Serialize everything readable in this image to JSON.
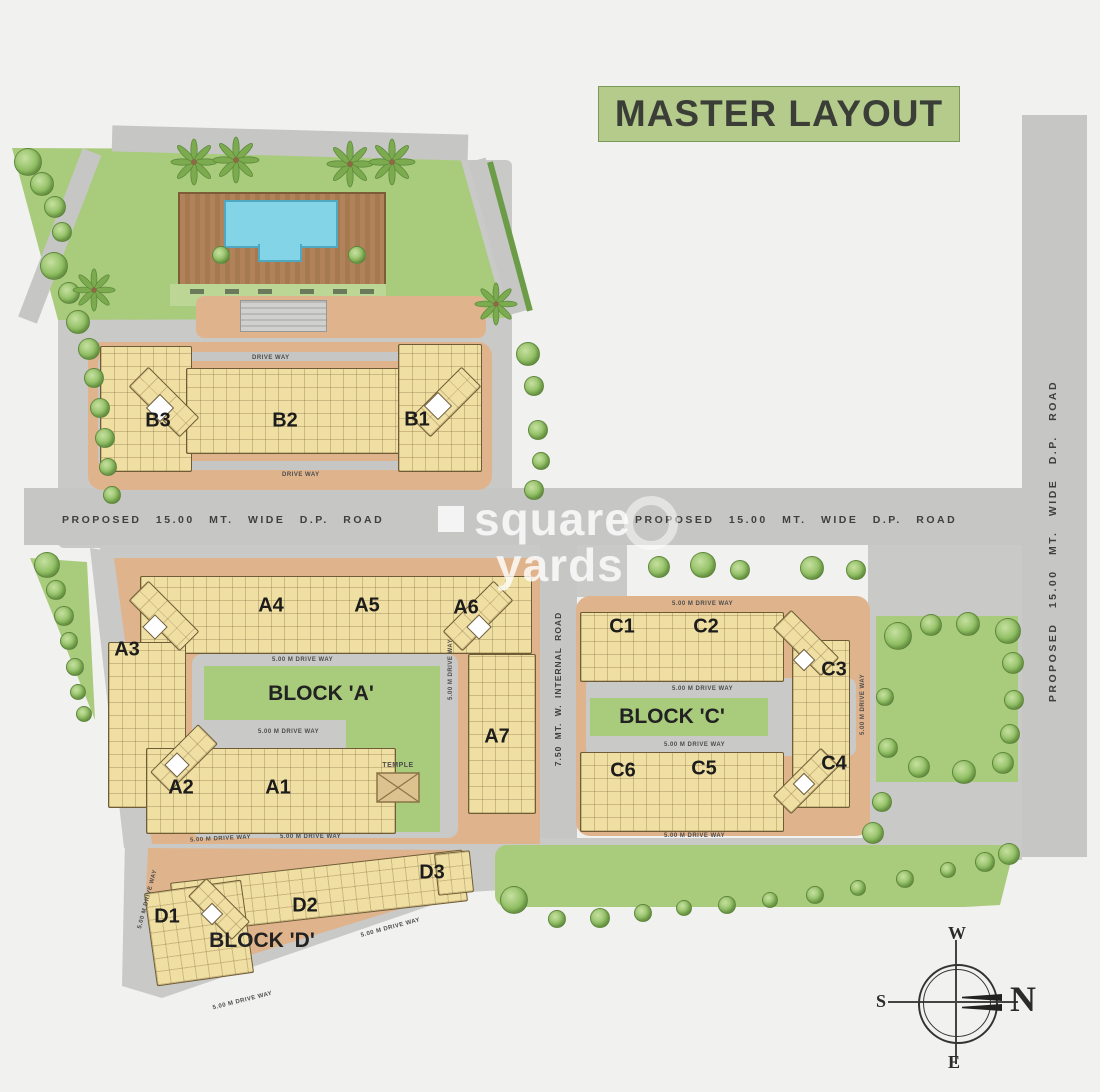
{
  "page": {
    "title": "MASTER LAYOUT"
  },
  "watermark": {
    "word1": "square",
    "word2": "yards"
  },
  "roads": {
    "dp_road": "PROPOSED 15.00 MT. WIDE D.P. ROAD",
    "internal_road": "7.50 MT. W. INTERNAL ROAD",
    "drive_way": "DRIVE WAY",
    "drive_way_5m": "5.00 M DRIVE WAY"
  },
  "blocks": {
    "a": {
      "name": "BLOCK 'A'",
      "buildings": [
        "A1",
        "A2",
        "A3",
        "A4",
        "A5",
        "A6",
        "A7"
      ]
    },
    "b": {
      "buildings": [
        "B1",
        "B2",
        "B3"
      ]
    },
    "c": {
      "name": "BLOCK 'C'",
      "buildings": [
        "C1",
        "C2",
        "C3",
        "C4",
        "C5",
        "C6"
      ]
    },
    "d": {
      "name": "BLOCK 'D'",
      "buildings": [
        "D1",
        "D2",
        "D3"
      ]
    }
  },
  "amenities": {
    "temple_label": "TEMPLE"
  },
  "compass": {
    "north": "N",
    "south": "S",
    "east": "E",
    "west": "W"
  },
  "colors": {
    "title_bg": "#b4cb8c",
    "road": "#c6c6c5",
    "plot": "#dfb48d",
    "building": "#f0dfa2",
    "lawn": "#a9cb7c",
    "pool": "#82d4e6",
    "deck": "#ad8055",
    "tree": "#8fbe62"
  }
}
